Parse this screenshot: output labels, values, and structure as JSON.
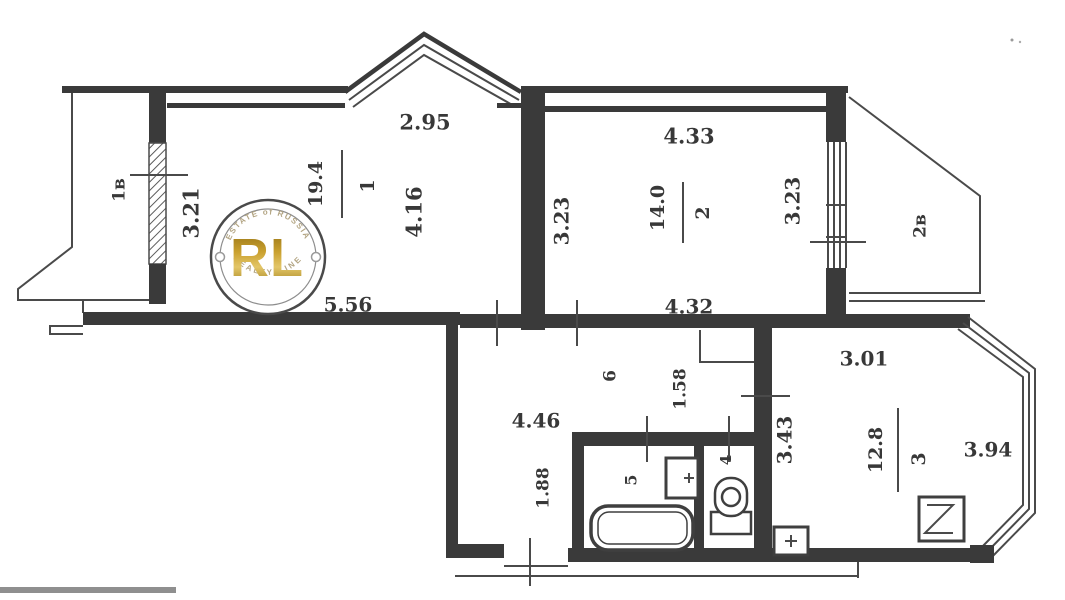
{
  "plan": {
    "rooms": {
      "room1": {
        "number": "1",
        "area": "19.4"
      },
      "room2": {
        "number": "2",
        "area": "14.0"
      },
      "room3": {
        "number": "3",
        "area": "12.8"
      },
      "hall": {
        "number": "6"
      },
      "bathroom": {
        "number": "5"
      },
      "wc": {
        "number": "4"
      },
      "balcony_left": {
        "label": "1в"
      },
      "balcony_right": {
        "label": "2в"
      }
    },
    "dimensions": {
      "room1_bay_width": "2.95",
      "room1_right": "4.16",
      "room1_left": "3.21",
      "room1_bottom": "5.56",
      "room2_top": "4.33",
      "room2_left": "3.23",
      "room2_right": "3.23",
      "room2_bottom": "4.32",
      "room3_top": "3.01",
      "room3_left": "3.43",
      "room3_right": "3.94",
      "hall_width": "4.46",
      "hall_niche": "1.58",
      "hall_lower": "1.88"
    },
    "colors": {
      "line": "#3a3a3a",
      "gold": "#c49a2c"
    }
  },
  "watermark": {
    "top_text": "ESTATE of RUSSIA",
    "monogram": "RL",
    "bottom_text": "REALTY LINE"
  }
}
